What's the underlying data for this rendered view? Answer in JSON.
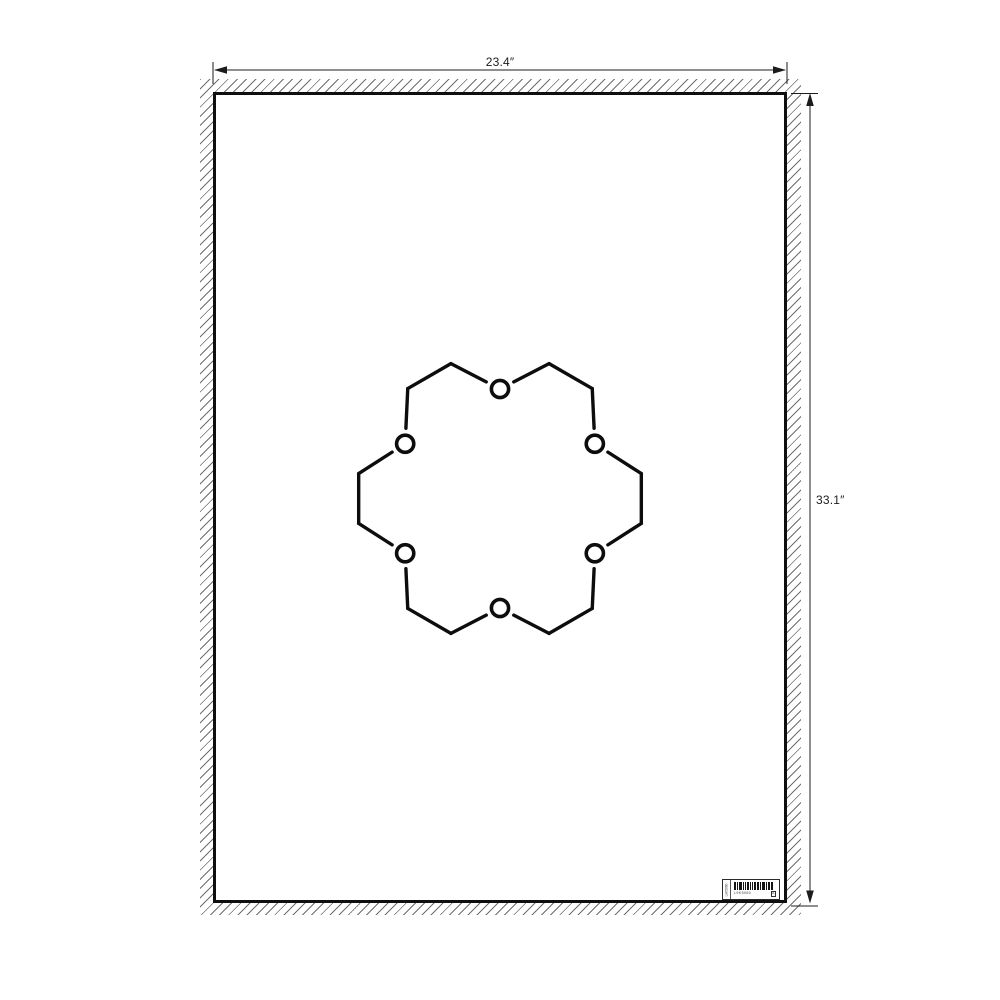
{
  "page": {
    "background": "#ffffff",
    "type": "poster-print-mockup-diagram"
  },
  "dimensions": {
    "width_label": "23.4″",
    "height_label": "33.1″",
    "line_color": "#1c1c1c"
  },
  "hatch": {
    "color": "#6e6e6e",
    "spacing_px": 6.5
  },
  "poster": {
    "border_color": "#0f0f0f",
    "background": "#ffffff",
    "molecule": {
      "name": "18-crown-6-crown-ether",
      "atom_label": "O",
      "oxygen_count": 6,
      "ring": {
        "center_x": 284,
        "center_y": 403.5,
        "o_radius": 109.5,
        "c_radius": 143.5,
        "o_angles": [
          90,
          150,
          210,
          270,
          330,
          30
        ],
        "vertex_step_deg": 20,
        "bond_width": 3.4,
        "o_circle_r": 8.6,
        "o_stroke": 3.6,
        "o_gap": 15.5,
        "color": "#0d0d0d"
      }
    },
    "barcode_label": {
      "side_text": "L9K5060",
      "code_text": "L9K5060",
      "box_letter": "A",
      "bars": "213112112213122",
      "bar_color": "#141414"
    }
  }
}
